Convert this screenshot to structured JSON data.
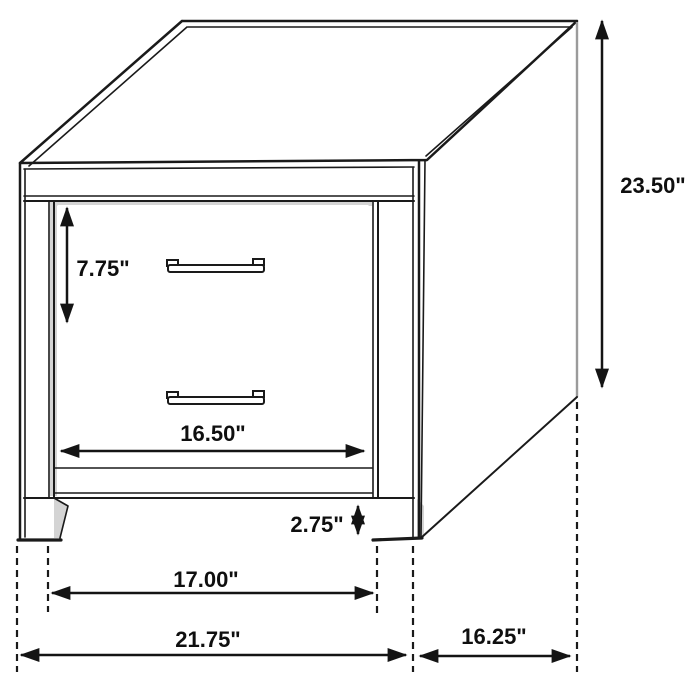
{
  "diagram": {
    "title": "Nightstand dimension line drawing",
    "subject": "two-drawer nightstand",
    "background_color": "#ffffff",
    "line_color": "#1a1a1a",
    "shade_color": "#d4d4d4",
    "units": "inches",
    "dimensions": {
      "overall_height": "23.50\"",
      "drawer_height": "7.75\"",
      "drawer_width": "16.50\"",
      "base_height": "2.75\"",
      "inner_leg_span": "17.00\"",
      "overall_width": "21.75\"",
      "overall_depth": "16.25\""
    }
  }
}
